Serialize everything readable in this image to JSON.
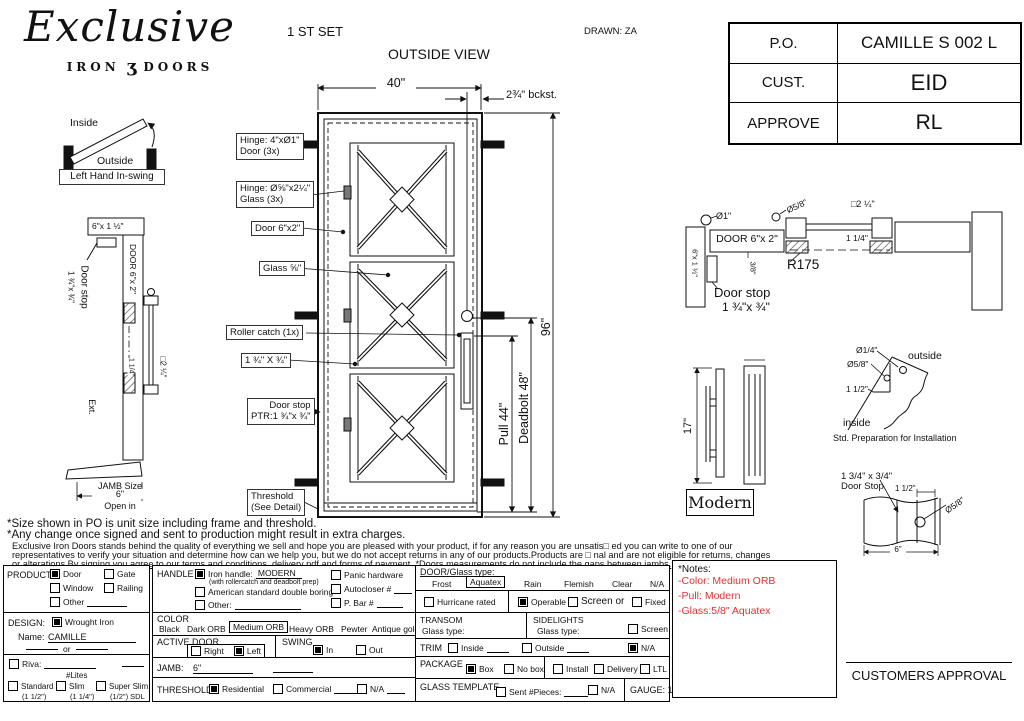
{
  "header": {
    "logo": {
      "script": "Exclusive",
      "iron": "IRON",
      "glyph": "ʒ",
      "doors": "DOORS"
    },
    "set_label": "1 ST SET",
    "view_title": "OUTSIDE VIEW",
    "drawn_label": "DRAWN: ZA",
    "approval_table": {
      "rows": [
        {
          "label": "P.O.",
          "value": "CAMILLE S 002 L"
        },
        {
          "label": "CUST.",
          "value": "EID"
        },
        {
          "label": "APPROVE",
          "value": "RL"
        }
      ]
    }
  },
  "swing": {
    "inside": "Inside",
    "outside": "Outside",
    "caption": "Left Hand In-swing"
  },
  "door": {
    "dim_width": "40\"",
    "dim_backset": "2¾\" bckst.",
    "dim_height": "96\"",
    "dim_pull": "Pull 44\"",
    "dim_deadbolt": "Deadbolt 48\"",
    "callouts": {
      "hinge_door_1": "Hinge: 4\"xØ1\"",
      "hinge_door_2": "Door (3x)",
      "hinge_glass_1": "Hinge: Ø⅝\"x2¼\"",
      "hinge_glass_2": "Glass (3x)",
      "door_frame": "Door 6\"x2\"",
      "glass": "Glass ⅝\"",
      "roller": "Roller catch  (1x)",
      "bar": "1 ¾\" X ¾\"",
      "stop_1": "Door stop",
      "stop_2": "PTR:1 ¾\"x ¾\"",
      "threshold_1": "Threshold",
      "threshold_2": "(See Detail)"
    }
  },
  "left_section": {
    "header_dim": "6\"x 1 ½\"",
    "door_label": "DOOR 6\"x 2\"",
    "stop_label": "Door stop",
    "stop_dim": "1 ¾\"x ¾\"",
    "dim_114": "1 1/4\"",
    "dim_sq": "□2 ¼\"",
    "ext": "Ext.",
    "jamb_size": "JAMB Size",
    "jamb_dim": "6\"",
    "open_in": "Open in"
  },
  "right_section": {
    "dia1": "Ø1\"",
    "dia58": "Ø5/8\"",
    "sq": "□2 ¼\"",
    "door_label": "DOOR 6\"x 2\"",
    "dim114": "1 1/4\"",
    "dim38": "3/8\"",
    "r175": "R175",
    "stop_label": "Door stop",
    "stop_dim": "1 ¾\"x ¾\"",
    "side_dim": "6\"x 1 ½\""
  },
  "handle": {
    "dim": "17\"",
    "name": "Modern"
  },
  "prep": {
    "dia14": "Ø1/4\"",
    "dia58": "Ø5/8\"",
    "dim112": "1 1/2\"",
    "outside": "outside",
    "inside": "inside",
    "caption": "Std. Preparation for Installation"
  },
  "stop_detail": {
    "label_1": "1 3/4\" x 3/4\"",
    "label_2": "Door Stop",
    "dim112": "1 1/2\"",
    "dia58": "Ø5/8\"",
    "dim6": "6\""
  },
  "disclaimer": {
    "line1": "*Size shown in PO is unit size including frame and threshold.",
    "line2": "*Any change once signed and sent to production might result in extra charges.",
    "line3": "Exclusive Iron Doors stands behind the quality of everything we sell and hope you are pleased with your product, if for any reason you are unsatis□ ed you can write to one of our",
    "line4": "representatives to verify your situation and determine how can we help you, but we do not accept returns in any of our products.Products are □ nal and are not eligible for returns, changes",
    "line5": "or alterations.By signing you agree to our terms and conditions, delivery pdf and forms of payment. *Doors measurements do not include the gaps between jambs."
  },
  "form": {
    "product": {
      "label": "PRODUCT:",
      "door": {
        "label": "Door",
        "checked": true
      },
      "gate": {
        "label": "Gate",
        "checked": false
      },
      "window": {
        "label": "Window",
        "checked": false
      },
      "railing": {
        "label": "Railing",
        "checked": false
      },
      "other": {
        "label": "Other",
        "checked": false
      }
    },
    "design": {
      "label": "DESIGN:",
      "wrought": {
        "label": "Wrought Iron",
        "checked": true
      },
      "name_label": "Name:",
      "name_value": "CAMILLE",
      "or": "or",
      "riva": {
        "label": "Riva:",
        "checked": false
      },
      "lites": "#Lites",
      "standard": {
        "label": "Standard",
        "sub": "(1 1/2\")",
        "checked": false
      },
      "slim": {
        "label": "Slim",
        "sub": "(1 1/4\")",
        "checked": false
      },
      "super_slim": {
        "label": "Super Slim",
        "sub": "(1/2\") SDL",
        "checked": false
      }
    },
    "handle": {
      "label": "HANDLE",
      "iron": {
        "label": "Iron handle:",
        "value": "MODERN",
        "checked": true
      },
      "iron_sub": "(with rollercatch and deadbolt prep)",
      "american": {
        "label": "American standard double boring",
        "checked": false
      },
      "other": {
        "label": "Other:",
        "checked": false
      },
      "panic": {
        "label": "Panic hardware",
        "checked": false
      },
      "autocloser": {
        "label": "Autocloser #",
        "checked": false
      },
      "pbar": {
        "label": "P. Bar #",
        "checked": false
      }
    },
    "color": {
      "label": "COLOR",
      "options": [
        "Black",
        "Dark ORB",
        "Medium ORB",
        "Heavy ORB",
        "Pewter",
        "Antique gold"
      ],
      "selected": "Medium ORB"
    },
    "active_door": {
      "label": "ACTIVE DOOR",
      "right": {
        "label": "Right",
        "checked": false
      },
      "left": {
        "label": "Left",
        "checked": true
      }
    },
    "swing": {
      "label": "SWING",
      "in": {
        "label": "In",
        "checked": true
      },
      "out": {
        "label": "Out",
        "checked": false
      }
    },
    "jamb": {
      "label": "JAMB:",
      "value": "6\""
    },
    "threshold": {
      "label": "THRESHOLD",
      "residential": {
        "label": "Residential",
        "checked": true
      },
      "commercial": {
        "label": "Commercial",
        "checked": false
      },
      "na": {
        "label": "N/A",
        "checked": false
      }
    },
    "door_glass": {
      "label": "DOOR/Glass type:",
      "frost": "Frost",
      "aquatex": "Aquatex",
      "rain": "Rain",
      "flemish": "Flemish",
      "clear": "Clear",
      "na": "N/A",
      "selected": "Aquatex"
    },
    "hurricane": {
      "label": "Hurricane rated",
      "checked": false
    },
    "operable": {
      "label": "Operable",
      "checked": true
    },
    "screen_or": {
      "label": "Screen or",
      "checked": false
    },
    "fixed": {
      "label": "Fixed",
      "checked": false
    },
    "transom": {
      "label": "TRANSOM",
      "glass_label": "Glass type:"
    },
    "sidelights": {
      "label": "SIDELIGHTS",
      "glass_label": "Glass type:",
      "screen": {
        "label": "Screen",
        "checked": false
      }
    },
    "trim": {
      "label": "TRIM",
      "inside": {
        "label": "Inside",
        "checked": false
      },
      "outside": {
        "label": "Outside",
        "checked": false
      },
      "na": {
        "label": "N/A",
        "checked": true
      }
    },
    "package": {
      "label": "PACKAGE",
      "box": {
        "label": "Box",
        "checked": true
      },
      "no_box": {
        "label": "No box",
        "checked": false
      },
      "install": {
        "label": "Install",
        "checked": false
      },
      "delivery": {
        "label": "Delivery",
        "checked": false
      },
      "ltl": {
        "label": "LTL",
        "checked": false
      }
    },
    "glass_template": {
      "label": "GLASS TEMPLATE",
      "sent": {
        "label": "Sent #Pieces:",
        "checked": false
      },
      "na": {
        "label": "N/A",
        "checked": false
      }
    },
    "gauge": "GAUGE: 14",
    "notes": {
      "title": "*Notes:",
      "lines": [
        "-Color: Medium ORB",
        "-Pull: Modern",
        "-Glass:5/8\"  Aquatex"
      ],
      "color": "#e03434"
    },
    "approval": "CUSTOMERS APPROVAL"
  }
}
